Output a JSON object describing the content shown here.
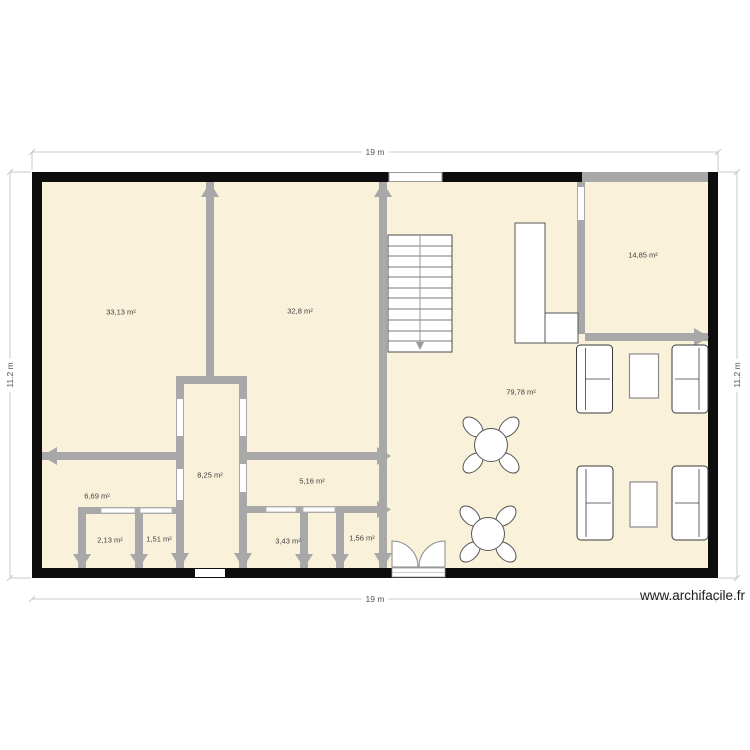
{
  "plan": {
    "dimension_labels": {
      "top": "19 m",
      "bottom": "19 m",
      "left": "11.2 m",
      "right": "11.2 m"
    },
    "rooms": [
      {
        "name": "room-top-left",
        "area": "33,13 m²"
      },
      {
        "name": "room-top-middle",
        "area": "32,8 m²"
      },
      {
        "name": "room-top-right",
        "area": "14,85 m²"
      },
      {
        "name": "living-room",
        "area": "79,78 m²"
      },
      {
        "name": "corridor",
        "area": "8,25 m²"
      },
      {
        "name": "room-mid-right",
        "area": "5,16 m²"
      },
      {
        "name": "room-bottom-left",
        "area": "6,69 m²"
      },
      {
        "name": "small-room-1",
        "area": "2,13 m²"
      },
      {
        "name": "small-room-2",
        "area": "1,51 m²"
      },
      {
        "name": "small-room-3",
        "area": "3,43 m²"
      },
      {
        "name": "small-room-4",
        "area": "1,56 m²"
      }
    ],
    "furniture": [
      "staircase",
      "closet",
      "sofa",
      "coffee-table",
      "round-table-with-chairs",
      "double-door"
    ],
    "colors": {
      "room_fill": "#f9f1da",
      "outer_wall": "#0d0d0d",
      "inner_wall": "#a8a8a8",
      "furniture_stroke": "#444444",
      "dimension_line": "#c8c8c8",
      "label_text": "#3d3d3d"
    }
  },
  "watermark": {
    "text": "www.archifacile.fr"
  }
}
